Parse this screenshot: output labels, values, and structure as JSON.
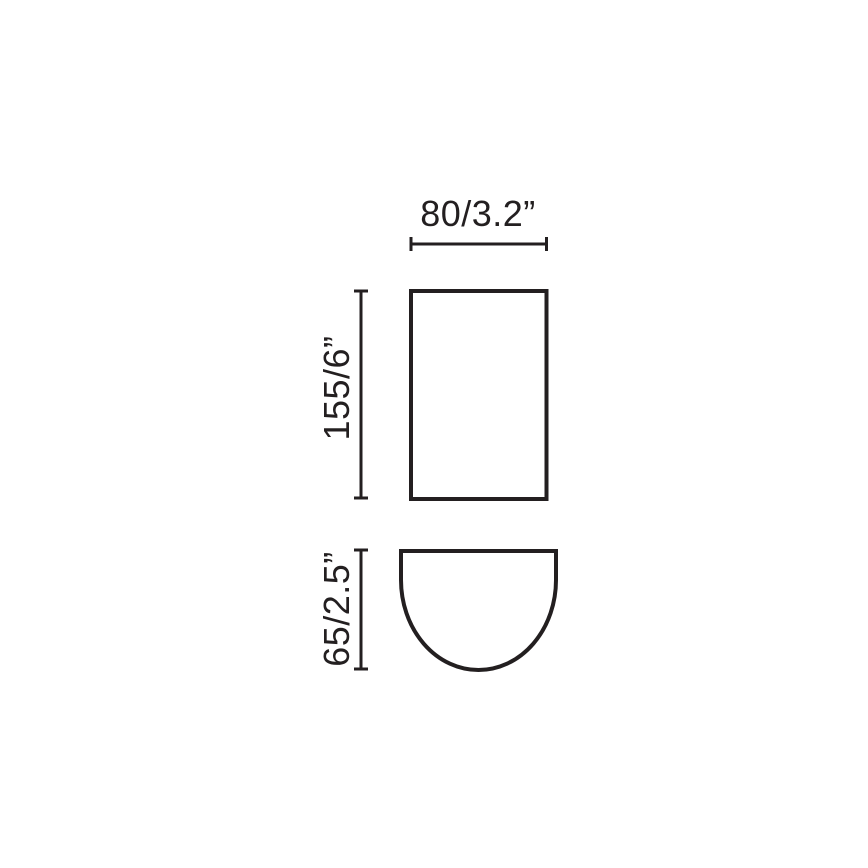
{
  "diagram": {
    "front_view": {
      "width_label": "80/3.2”",
      "height_label": "155/6”"
    },
    "profile_view": {
      "depth_label": "65/2.5”"
    }
  },
  "colors": {
    "line": "#231f20",
    "background": "#ffffff"
  }
}
